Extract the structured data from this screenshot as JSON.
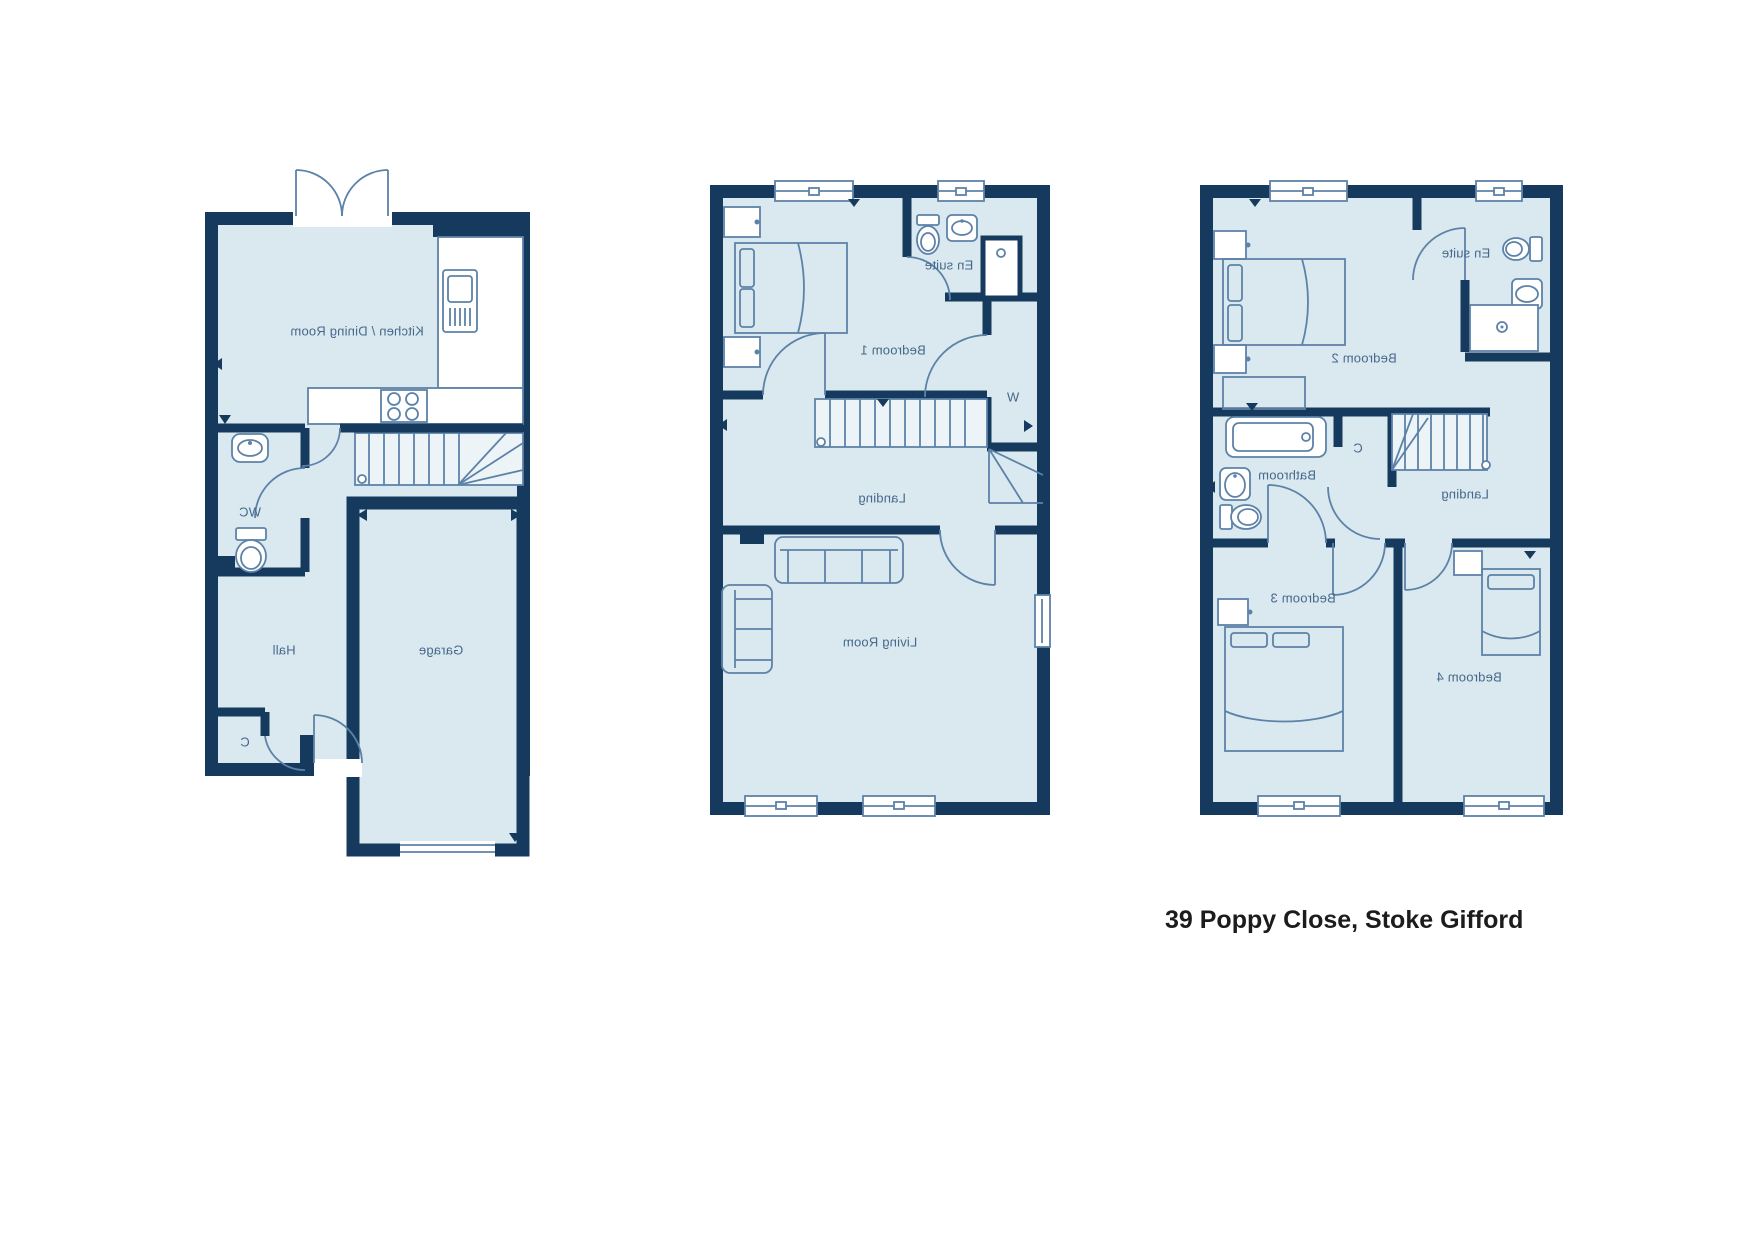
{
  "caption": "39 Poppy Close, Stoke Gifford",
  "colors": {
    "wall": "#163a5e",
    "room_fill": "#d9e9ef",
    "furniture_line": "#5d82a8",
    "label_text": "#47688c",
    "fixture_fill": "#ffffff",
    "caption_text": "#1c1c1c"
  },
  "plans": [
    {
      "id": "ground-floor",
      "labels": {
        "kitchen_dining": "Kitchen / Dining Room",
        "wc": "WC",
        "hall": "Hall",
        "garage": "Garage",
        "cupboard": "C"
      }
    },
    {
      "id": "first-floor",
      "labels": {
        "bedroom1": "Bedroom 1",
        "en_suite": "En suite",
        "wardrobe": "W",
        "landing": "Landing",
        "living_room": "Living Room"
      }
    },
    {
      "id": "second-floor",
      "labels": {
        "bedroom2": "Bedroom 2",
        "en_suite": "En suite",
        "bathroom": "Bathroom",
        "cupboard": "C",
        "landing": "Landing",
        "bedroom3": "Bedroom 3",
        "bedroom4": "Bedroom 4"
      }
    }
  ]
}
